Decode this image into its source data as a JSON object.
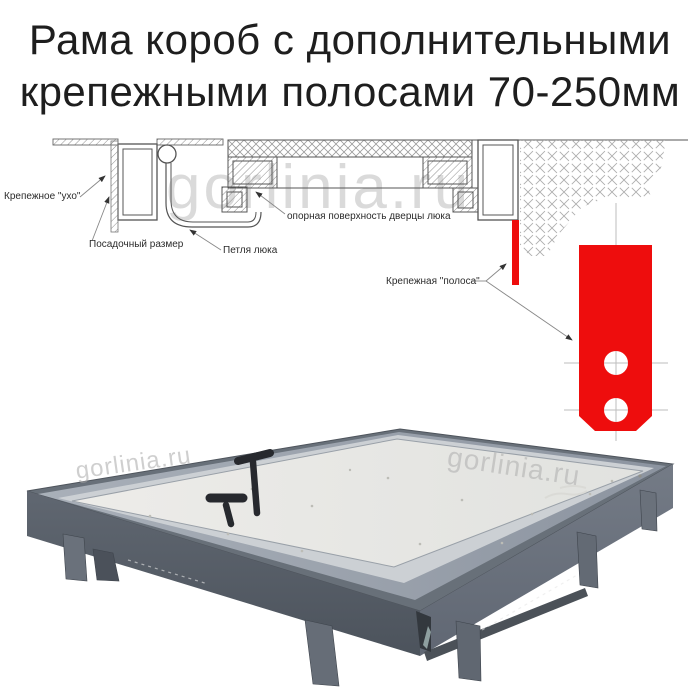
{
  "title": {
    "line1": "Рама короб с дополнительными",
    "line2": "крепежными полосами 70-250мм"
  },
  "watermark": "gorlinia.ru",
  "diagram": {
    "labels": {
      "ear": "Крепежное \"ухо\"",
      "seating": "Посадочный размер",
      "hinge": "Петля люка",
      "support": "опорная поверхность дверцы люка",
      "strip": "Крепежная \"полоса\""
    },
    "colors": {
      "strip_red": "#ee0d0d",
      "line": "#555555"
    }
  }
}
